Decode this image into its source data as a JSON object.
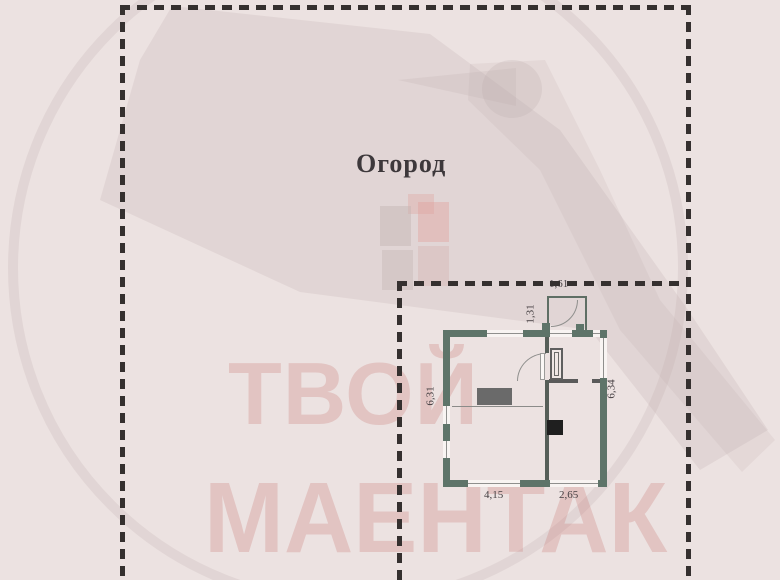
{
  "scene": {
    "area_label": "Огород"
  },
  "plan": {
    "dimensions": {
      "porch_width": "1,61",
      "porch_depth": "1,31",
      "left_side": "6,31",
      "right_side": "6,34",
      "bottom_left_room": "4,15",
      "bottom_right_room": "2,65"
    }
  },
  "watermark": {
    "line1": "ТВОЙ",
    "line2": "МАЕНТАК",
    "logo": "stork-in-circle"
  },
  "colors": {
    "background": "#ece2e1",
    "wall_accent": "#5e7469",
    "dashed_boundary": "#35302f",
    "watermark_red": "#c97672",
    "stove_fill": "#6a6a6a",
    "black_box_fill": "#1f1f1f"
  }
}
